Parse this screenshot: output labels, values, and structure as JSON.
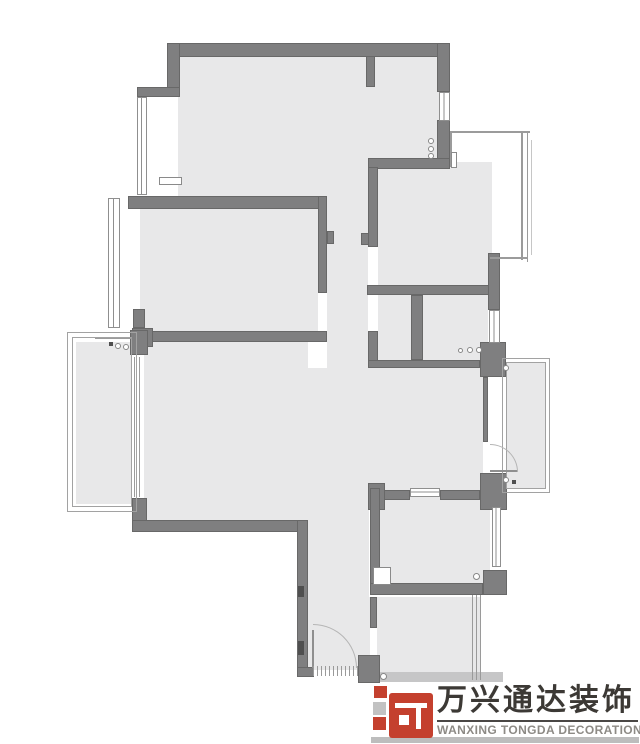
{
  "page": {
    "background": "#ffffff",
    "type": "apartment floor plan"
  },
  "plan": {
    "colors": {
      "floor": "#e8e8e9",
      "wall": "#7f7f80",
      "wall_edge": "#686868",
      "thin_line": "#9b9b9b",
      "accent_red": "#c4402e"
    },
    "elements": [
      {
        "t": "floor",
        "n": "floor-top-room",
        "x": 178,
        "y": 56,
        "w": 267,
        "h": 106
      },
      {
        "t": "floor",
        "n": "floor-top-room-lower",
        "x": 178,
        "y": 162,
        "w": 190,
        "h": 34
      },
      {
        "t": "floor",
        "n": "floor-top-middle-room",
        "x": 368,
        "y": 162,
        "w": 124,
        "h": 133
      },
      {
        "t": "floor",
        "n": "floor-corridor",
        "x": 327,
        "y": 196,
        "w": 41,
        "h": 174
      },
      {
        "t": "floor",
        "n": "floor-bedroom-left",
        "x": 140,
        "y": 209,
        "w": 187,
        "h": 124
      },
      {
        "t": "floor",
        "n": "floor-living-room",
        "x": 140,
        "y": 340,
        "w": 168,
        "h": 182
      },
      {
        "t": "floor",
        "n": "floor-entry-strip",
        "x": 307,
        "y": 368,
        "w": 62,
        "h": 302
      },
      {
        "t": "floor",
        "n": "floor-hall",
        "x": 369,
        "y": 368,
        "w": 119,
        "h": 122
      },
      {
        "t": "floor",
        "n": "floor-small-room-left",
        "x": 378,
        "y": 295,
        "w": 33,
        "h": 65
      },
      {
        "t": "floor",
        "n": "floor-small-room-right",
        "x": 423,
        "y": 295,
        "w": 65,
        "h": 65
      },
      {
        "t": "floor",
        "n": "floor-bath-middle",
        "x": 380,
        "y": 497,
        "w": 110,
        "h": 88
      },
      {
        "t": "floor",
        "n": "floor-bottom-room",
        "x": 368,
        "y": 597,
        "w": 112,
        "h": 83
      },
      {
        "t": "floor",
        "n": "floor-balcony-left",
        "x": 76,
        "y": 342,
        "w": 57,
        "h": 162
      },
      {
        "t": "floor",
        "n": "floor-balcony-right",
        "x": 506,
        "y": 362,
        "w": 40,
        "h": 127
      },
      {
        "t": "gap",
        "n": "door-opening-bedroom",
        "x": 318,
        "y": 293,
        "w": 9,
        "h": 38
      },
      {
        "t": "gap",
        "n": "door-opening-top-middle",
        "x": 368,
        "y": 246,
        "w": 10,
        "h": 40
      },
      {
        "t": "gap",
        "n": "door-opening-small-room",
        "x": 368,
        "y": 295,
        "w": 10,
        "h": 36
      },
      {
        "t": "gap",
        "n": "door-opening-balcony-right",
        "x": 483,
        "y": 442,
        "w": 5,
        "h": 31
      },
      {
        "t": "gap",
        "n": "door-opening-bottom-room",
        "x": 370,
        "y": 628,
        "w": 7,
        "h": 28
      },
      {
        "t": "gap",
        "n": "slider-opening-balcony-left",
        "x": 132,
        "y": 354,
        "w": 12,
        "h": 145
      },
      {
        "t": "wall",
        "n": "wall-top",
        "x": 167,
        "y": 43,
        "w": 283,
        "h": 14
      },
      {
        "t": "wall",
        "n": "wall-left-upper",
        "x": 167,
        "y": 43,
        "w": 13,
        "h": 46
      },
      {
        "t": "wall",
        "n": "wall-cap-left",
        "x": 137,
        "y": 87,
        "w": 43,
        "h": 10
      },
      {
        "t": "wall",
        "n": "wall-stub-top",
        "x": 366,
        "y": 56,
        "w": 9,
        "h": 31
      },
      {
        "t": "wall",
        "n": "wall-right-upper",
        "x": 437,
        "y": 43,
        "w": 13,
        "h": 49
      },
      {
        "t": "wall",
        "n": "wall-right-mid",
        "x": 437,
        "y": 120,
        "w": 13,
        "h": 47
      },
      {
        "t": "wall",
        "n": "wall-topmiddle-top",
        "x": 368,
        "y": 158,
        "w": 82,
        "h": 11
      },
      {
        "t": "wall",
        "n": "wall-bedroom-top",
        "x": 128,
        "y": 196,
        "w": 199,
        "h": 13
      },
      {
        "t": "wall",
        "n": "wall-topmiddle-left",
        "x": 368,
        "y": 167,
        "w": 10,
        "h": 80
      },
      {
        "t": "wall",
        "n": "wall-stub-corridor-left",
        "x": 361,
        "y": 233,
        "w": 8,
        "h": 12
      },
      {
        "t": "wall",
        "n": "wall-jamb-corridor",
        "x": 327,
        "y": 231,
        "w": 7,
        "h": 13
      },
      {
        "t": "wall",
        "n": "wall-bedroom-right",
        "x": 318,
        "y": 196,
        "w": 9,
        "h": 97
      },
      {
        "t": "wall",
        "n": "wall-bedroom-bottom",
        "x": 152,
        "y": 331,
        "w": 175,
        "h": 11
      },
      {
        "t": "wall",
        "n": "pillar-a",
        "x": 133,
        "y": 309,
        "w": 12,
        "h": 19
      },
      {
        "t": "wall",
        "n": "pillar-b",
        "x": 132,
        "y": 328,
        "w": 21,
        "h": 19
      },
      {
        "t": "wall",
        "n": "pillar-c",
        "x": 132,
        "y": 347,
        "w": 14,
        "h": 8
      },
      {
        "t": "wall",
        "n": "wall-center-horizontal",
        "x": 367,
        "y": 285,
        "w": 126,
        "h": 10
      },
      {
        "t": "wall",
        "n": "wall-divider",
        "x": 411,
        "y": 295,
        "w": 12,
        "h": 65
      },
      {
        "t": "wall",
        "n": "wall-smallroom-left-lower",
        "x": 368,
        "y": 331,
        "w": 10,
        "h": 30
      },
      {
        "t": "wall",
        "n": "wall-smallrooms-bottom",
        "x": 368,
        "y": 360,
        "w": 112,
        "h": 8
      },
      {
        "t": "wall",
        "n": "wall-right-center",
        "x": 488,
        "y": 253,
        "w": 12,
        "h": 57
      },
      {
        "t": "wall",
        "n": "pillar-right-top",
        "x": 480,
        "y": 342,
        "w": 26,
        "h": 35
      },
      {
        "t": "wall",
        "n": "wall-thin-right",
        "x": 483,
        "y": 377,
        "w": 5,
        "h": 65
      },
      {
        "t": "wall",
        "n": "pillar-right-bottom",
        "x": 480,
        "y": 473,
        "w": 27,
        "h": 37
      },
      {
        "t": "wall",
        "n": "wall-bath-top-right",
        "x": 440,
        "y": 490,
        "w": 40,
        "h": 10
      },
      {
        "t": "wall",
        "n": "wall-bath-top-left",
        "x": 382,
        "y": 490,
        "w": 28,
        "h": 10
      },
      {
        "t": "wall",
        "n": "wall-bath-corner-t",
        "x": 368,
        "y": 483,
        "w": 17,
        "h": 27
      },
      {
        "t": "wall",
        "n": "wall-bath-left",
        "x": 370,
        "y": 488,
        "w": 10,
        "h": 107
      },
      {
        "t": "wall",
        "n": "wall-bath-bottom",
        "x": 370,
        "y": 583,
        "w": 113,
        "h": 12
      },
      {
        "t": "wall",
        "n": "corner-bath-right-bottom",
        "x": 483,
        "y": 570,
        "w": 24,
        "h": 25
      },
      {
        "t": "wall",
        "n": "corner-living-left",
        "x": 132,
        "y": 498,
        "w": 15,
        "h": 34
      },
      {
        "t": "wall",
        "n": "wall-living-bottom",
        "x": 132,
        "y": 520,
        "w": 176,
        "h": 12
      },
      {
        "t": "wall",
        "n": "wall-entry-left",
        "x": 297,
        "y": 520,
        "w": 11,
        "h": 157
      },
      {
        "t": "wall",
        "n": "wall-entry-bottom-left",
        "x": 297,
        "y": 667,
        "w": 17,
        "h": 10
      },
      {
        "t": "wall",
        "n": "wall-entry-block-right",
        "x": 358,
        "y": 655,
        "w": 22,
        "h": 28
      },
      {
        "t": "wall",
        "n": "wall-seg-bottomroom",
        "x": 370,
        "y": 597,
        "w": 7,
        "h": 31
      },
      {
        "t": "wall",
        "n": "pillar-balcony-slider-top",
        "x": 130,
        "y": 330,
        "w": 18,
        "h": 25
      },
      {
        "t": "slab",
        "n": "slab-bottom-edge",
        "x": 380,
        "y": 672,
        "w": 123,
        "h": 10
      },
      {
        "t": "win-v",
        "n": "window-top-left",
        "x": 137,
        "y": 97,
        "w": 10,
        "h": 98
      },
      {
        "t": "win-v",
        "n": "window-bedroom-left",
        "x": 108,
        "y": 198,
        "w": 12,
        "h": 130
      },
      {
        "t": "win-v",
        "n": "window-top-right",
        "x": 439,
        "y": 92,
        "w": 11,
        "h": 29
      },
      {
        "t": "win-v",
        "n": "window-right-center",
        "x": 489,
        "y": 310,
        "w": 11,
        "h": 33
      },
      {
        "t": "win-v",
        "n": "window-bath-right",
        "x": 492,
        "y": 507,
        "w": 9,
        "h": 60
      },
      {
        "t": "win-h",
        "n": "window-bath-top",
        "x": 410,
        "y": 488,
        "w": 30,
        "h": 9
      },
      {
        "t": "frame",
        "n": "balcony-left-frame-outer",
        "x": 67,
        "y": 332,
        "w": 70,
        "h": 180
      },
      {
        "t": "frame",
        "n": "balcony-left-frame-inner",
        "x": 72,
        "y": 337,
        "w": 60,
        "h": 170
      },
      {
        "t": "frame",
        "n": "balcony-right-frame-outer",
        "x": 502,
        "y": 358,
        "w": 48,
        "h": 135
      },
      {
        "t": "frame",
        "n": "balcony-right-frame-inner",
        "x": 506,
        "y": 362,
        "w": 40,
        "h": 127
      },
      {
        "t": "line",
        "n": "baywindow-top-line",
        "x": 450,
        "y": 131,
        "w": 80,
        "h": 2
      },
      {
        "t": "line",
        "n": "baywindow-right-line",
        "x": 521,
        "y": 131,
        "w": 2,
        "h": 129
      },
      {
        "t": "line",
        "n": "baywindow-right-line2",
        "x": 527,
        "y": 131,
        "w": 1,
        "h": 131
      },
      {
        "t": "line",
        "n": "baywindow-bottom-line",
        "x": 490,
        "y": 257,
        "w": 38,
        "h": 2
      },
      {
        "t": "line",
        "n": "baywindow-left-line",
        "x": 450,
        "y": 131,
        "w": 2,
        "h": 36
      },
      {
        "t": "line-light",
        "n": "baywindow-outer-faint",
        "x": 531,
        "y": 140,
        "w": 1,
        "h": 115
      },
      {
        "t": "line",
        "n": "slider-line-1",
        "x": 134,
        "y": 357,
        "w": 1,
        "h": 140
      },
      {
        "t": "line",
        "n": "slider-line-2",
        "x": 139,
        "y": 357,
        "w": 1,
        "h": 140
      },
      {
        "t": "line",
        "n": "balcony-left-top-line",
        "x": 95,
        "y": 338,
        "w": 37,
        "h": 1
      },
      {
        "t": "leaf",
        "n": "entry-door-leaf",
        "x": 312,
        "y": 630,
        "w": 2,
        "h": 38
      },
      {
        "t": "arc-ne",
        "n": "entry-door-arc",
        "x": 313,
        "y": 624,
        "w": 44,
        "h": 44
      },
      {
        "t": "leaf",
        "n": "balcony-door-leaf",
        "x": 490,
        "y": 470,
        "w": 28,
        "h": 2
      },
      {
        "t": "arc-ne",
        "n": "balcony-door-arc",
        "x": 490,
        "y": 444,
        "w": 28,
        "h": 28
      },
      {
        "t": "hatch",
        "n": "entry-threshold-hatch",
        "x": 313,
        "y": 666,
        "w": 45,
        "h": 10
      },
      {
        "t": "hatch",
        "n": "bottomroom-right-hatch",
        "x": 472,
        "y": 595,
        "w": 11,
        "h": 85
      },
      {
        "t": "circle",
        "n": "symbol-circles-topright-1",
        "x": 428,
        "y": 138,
        "w": 6,
        "h": 6
      },
      {
        "t": "circle",
        "n": "symbol-circles-topright-2",
        "x": 428,
        "y": 146,
        "w": 6,
        "h": 6
      },
      {
        "t": "circle",
        "n": "symbol-circles-topright-3",
        "x": 428,
        "y": 153,
        "w": 6,
        "h": 6
      },
      {
        "t": "circle",
        "n": "symbol-kitchen-1",
        "x": 458,
        "y": 348,
        "w": 5,
        "h": 5
      },
      {
        "t": "circle",
        "n": "symbol-kitchen-2",
        "x": 467,
        "y": 347,
        "w": 6,
        "h": 6
      },
      {
        "t": "circle",
        "n": "symbol-kitchen-3",
        "x": 476,
        "y": 347,
        "w": 6,
        "h": 6
      },
      {
        "t": "circle",
        "n": "symbol-balcony-right-top",
        "x": 503,
        "y": 365,
        "w": 6,
        "h": 6
      },
      {
        "t": "circle",
        "n": "symbol-balcony-right-bottom",
        "x": 503,
        "y": 477,
        "w": 6,
        "h": 6
      },
      {
        "t": "circle",
        "n": "symbol-bath-drain",
        "x": 473,
        "y": 573,
        "w": 7,
        "h": 7
      },
      {
        "t": "circle",
        "n": "symbol-bottomroom-drain",
        "x": 380,
        "y": 673,
        "w": 7,
        "h": 7
      },
      {
        "t": "circle",
        "n": "symbol-washer-1",
        "x": 115,
        "y": 343,
        "w": 6,
        "h": 6
      },
      {
        "t": "circle",
        "n": "symbol-washer-2",
        "x": 123,
        "y": 344,
        "w": 6,
        "h": 6
      },
      {
        "t": "mark",
        "n": "mark-entry-wall-1",
        "x": 298,
        "y": 586,
        "w": 6,
        "h": 11
      },
      {
        "t": "mark",
        "n": "mark-entry-wall-2",
        "x": 298,
        "y": 641,
        "w": 6,
        "h": 14
      },
      {
        "t": "mark",
        "n": "mark-washer-box",
        "x": 109,
        "y": 342,
        "w": 4,
        "h": 4
      },
      {
        "t": "mark",
        "n": "mark-balcony-right-dot",
        "x": 512,
        "y": 480,
        "w": 4,
        "h": 4
      },
      {
        "t": "wrect",
        "n": "column-top-room",
        "x": 159,
        "y": 177,
        "w": 23,
        "h": 8
      },
      {
        "t": "wrect",
        "n": "column-baywindow",
        "x": 451,
        "y": 152,
        "w": 6,
        "h": 16
      },
      {
        "t": "wrect",
        "n": "shower-square",
        "x": 373,
        "y": 567,
        "w": 18,
        "h": 18
      }
    ]
  },
  "logo": {
    "brand_cn": "万兴通达装饰",
    "brand_en": "WANXING TONGDA DECORATION",
    "colors": {
      "red": "#c4402e",
      "gray_square": "#c2c2c2",
      "text": "#3c3935",
      "subtext": "#8d8a85"
    }
  }
}
